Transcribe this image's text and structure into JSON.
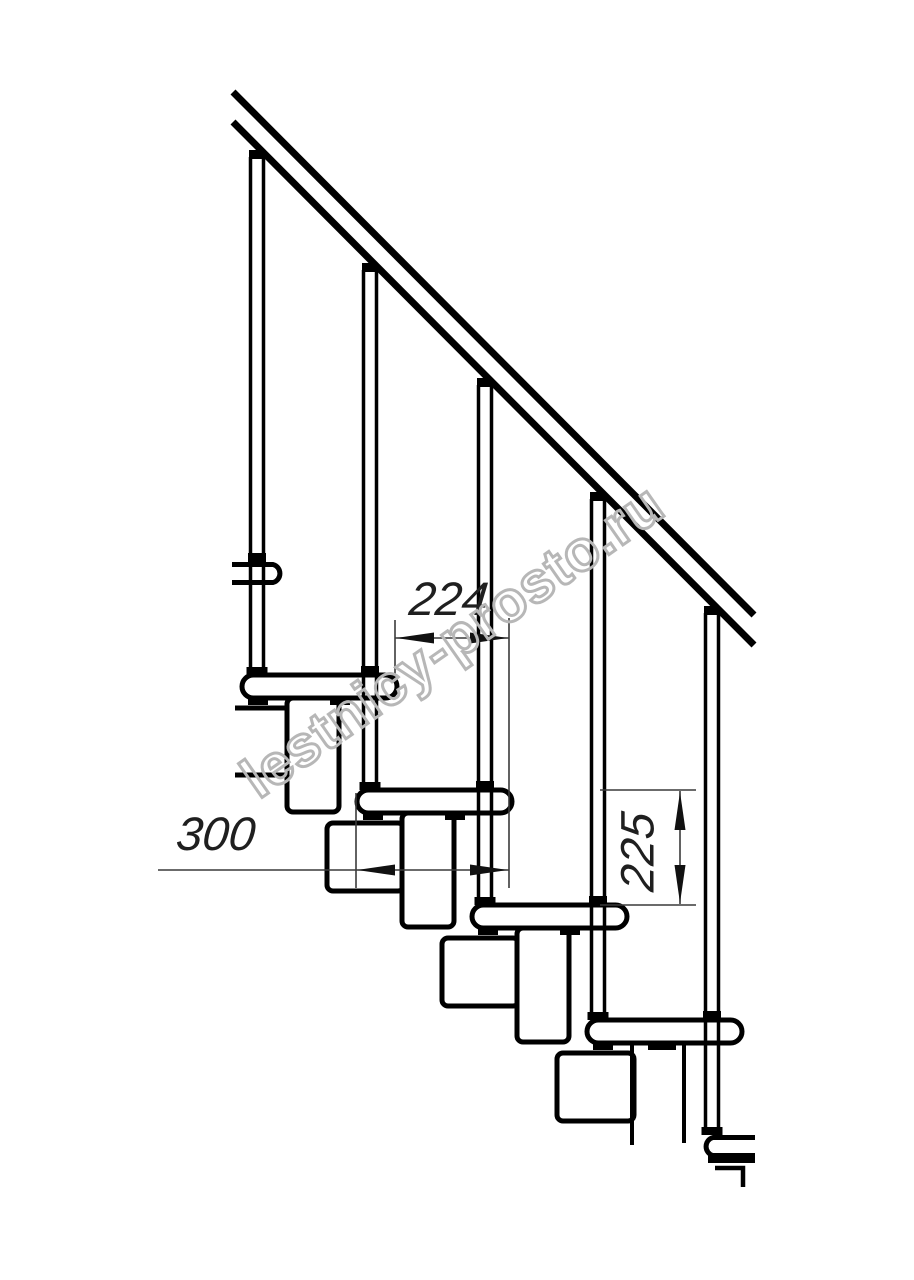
{
  "drawing": {
    "title": "Modular staircase side elevation drawing",
    "watermark": "lestnicy-prosto.ru",
    "dimensions": {
      "run": "224",
      "tread_length": "300",
      "rise": "225"
    },
    "colors": {
      "line": "#000000",
      "dimension_line": "#3a3a3a",
      "watermark_outline": "#b7b7b7",
      "background": "#ffffff"
    },
    "elements": {
      "balusters": 5,
      "treads": 6,
      "handrail": "diagonal double-line rail"
    }
  }
}
